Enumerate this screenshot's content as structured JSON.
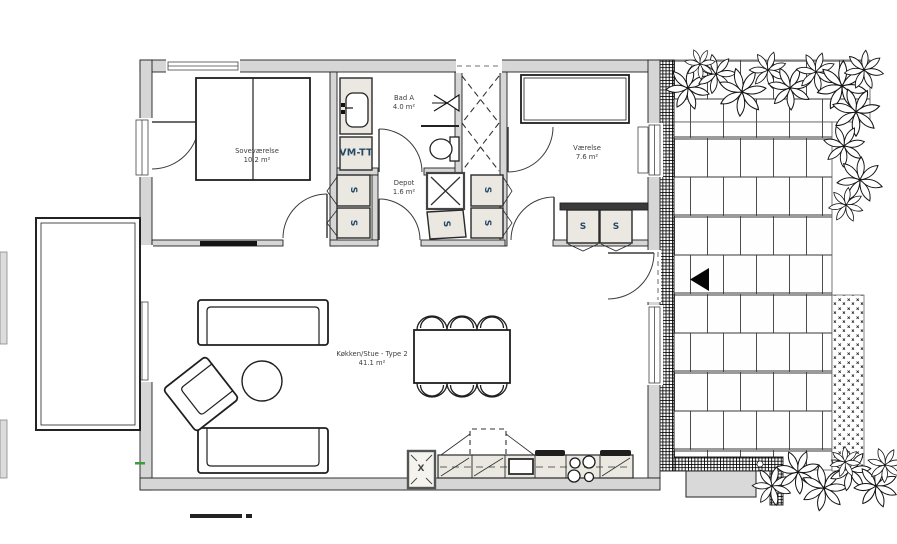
{
  "rooms": {
    "bedroom": {
      "name": "Soveværelse",
      "area": "10.2 m²"
    },
    "bathroom": {
      "name": "Bad A",
      "area": "4.0 m²"
    },
    "storage": {
      "name": "Depot",
      "area": "1.6 m²"
    },
    "room": {
      "name": "Værelse",
      "area": "7.6 m²"
    },
    "kitchen_living": {
      "name": "Køkken/Stue - Type 2",
      "area": "41.1 m²"
    }
  },
  "fixtures": {
    "washer_dryer": "VM-TT",
    "wardrobe": "S",
    "tall_cabinet": "X"
  },
  "icons": {
    "entrance_arrow": "entrance-arrow-icon",
    "shower": "shower-icon",
    "toilet": "toilet-icon",
    "sink": "sink-icon",
    "cooktop": "cooktop-icon",
    "plants": "plant-icon"
  },
  "colors": {
    "wall_fill": "#d6d6d6",
    "fixture_fill": "#eae8e0",
    "line": "#1b1b1b",
    "room_label": "#3d3d3d",
    "fixture_label": "#274968",
    "grout": "#9a9a9a"
  }
}
